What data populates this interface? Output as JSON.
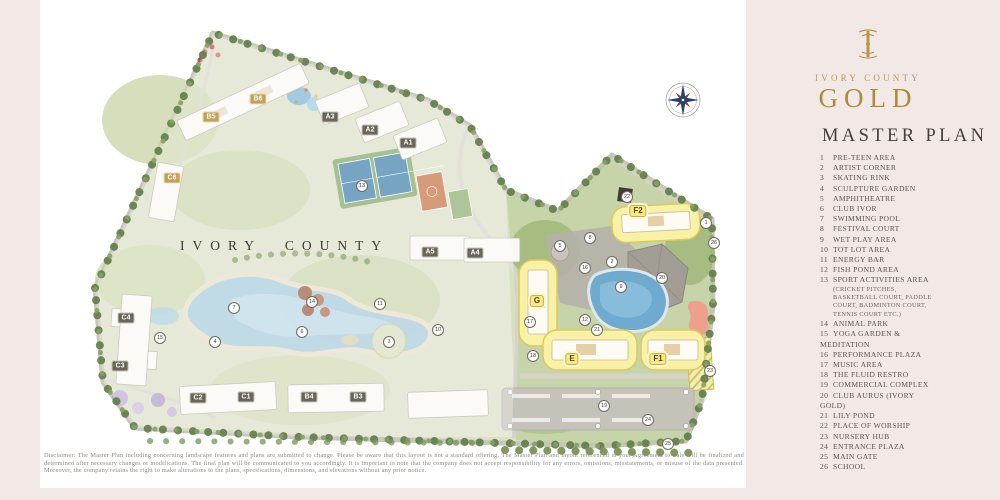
{
  "logo": {
    "brand": "IVORY COUNTY",
    "gold_word": "GOLD",
    "gold_color": "#ab8c3e"
  },
  "panel": {
    "title": "MASTER PLAN"
  },
  "legend": {
    "items": [
      {
        "n": "1",
        "label": "PRE-TEEN AREA"
      },
      {
        "n": "2",
        "label": "ARTIST CORNER"
      },
      {
        "n": "3",
        "label": "SKATING RINK"
      },
      {
        "n": "4",
        "label": "SCULPTURE GARDEN"
      },
      {
        "n": "5",
        "label": "AMPHITHEATRE"
      },
      {
        "n": "6",
        "label": "CLUB IVOR"
      },
      {
        "n": "7",
        "label": "SWIMMING POOL"
      },
      {
        "n": "8",
        "label": "FESTIVAL COURT"
      },
      {
        "n": "9",
        "label": "WET PLAY AREA"
      },
      {
        "n": "10",
        "label": "TOT LOT AREA"
      },
      {
        "n": "11",
        "label": "ENERGY BAR"
      },
      {
        "n": "12",
        "label": "FISH POND AREA"
      },
      {
        "n": "13",
        "label": "SPORT ACTIVITIES AREA",
        "sub": [
          "(CRICKET PITCHES,",
          "BASKETBALL COURT, PADDLE",
          "COURT, BADMINTON COURT,",
          "TENNIS  COURT ETC.)"
        ]
      },
      {
        "n": "14",
        "label": "ANIMAL PARK"
      },
      {
        "n": "15",
        "label": "YOGA GARDEN &",
        "cont": [
          "MEDITATION"
        ]
      },
      {
        "n": "16",
        "label": "PERFORMANCE PLAZA"
      },
      {
        "n": "17",
        "label": "MUSIC AREA"
      },
      {
        "n": "18",
        "label": "THE FLUID RESTRO"
      },
      {
        "n": "19",
        "label": "COMMERCIAL COMPLEX"
      },
      {
        "n": "20",
        "label": "CLUB AURUS (IVORY",
        "cont": [
          "GOLD)"
        ]
      },
      {
        "n": "21",
        "label": "LILY POND"
      },
      {
        "n": "22",
        "label": "PLACE OF WORSHIP"
      },
      {
        "n": "23",
        "label": "NURSERY HUB"
      },
      {
        "n": "24",
        "label": "ENTRANCE PLAZA"
      },
      {
        "n": "25",
        "label": "MAIN GATE"
      },
      {
        "n": "26",
        "label": "SCHOOL"
      }
    ]
  },
  "map": {
    "watermark": "IVORY COUNTY",
    "badges": [
      {
        "l": "B5",
        "x": 211,
        "y": 117,
        "s": "gold"
      },
      {
        "l": "B6",
        "x": 258,
        "y": 99,
        "s": "gold"
      },
      {
        "l": "A3",
        "x": 330,
        "y": 117,
        "s": "dark"
      },
      {
        "l": "A2",
        "x": 370,
        "y": 130,
        "s": "dark"
      },
      {
        "l": "A1",
        "x": 408,
        "y": 143,
        "s": "dark"
      },
      {
        "l": "A5",
        "x": 430,
        "y": 252,
        "s": "dark"
      },
      {
        "l": "A4",
        "x": 475,
        "y": 253,
        "s": "dark"
      },
      {
        "l": "C6",
        "x": 172,
        "y": 178,
        "s": "gold"
      },
      {
        "l": "C4",
        "x": 126,
        "y": 318,
        "s": "dark"
      },
      {
        "l": "C3",
        "x": 120,
        "y": 366,
        "s": "dark"
      },
      {
        "l": "C2",
        "x": 198,
        "y": 398,
        "s": "dark"
      },
      {
        "l": "C1",
        "x": 246,
        "y": 397,
        "s": "dark"
      },
      {
        "l": "B4",
        "x": 309,
        "y": 397,
        "s": "dark"
      },
      {
        "l": "B3",
        "x": 358,
        "y": 397,
        "s": "dark"
      },
      {
        "l": "F2",
        "x": 638,
        "y": 211,
        "s": "hl"
      },
      {
        "l": "G",
        "x": 537,
        "y": 301,
        "s": "hl"
      },
      {
        "l": "E",
        "x": 572,
        "y": 359,
        "s": "hl"
      },
      {
        "l": "F1",
        "x": 658,
        "y": 359,
        "s": "hl"
      }
    ],
    "markers": [
      {
        "n": "1",
        "x": 706,
        "y": 223
      },
      {
        "n": "2",
        "x": 612,
        "y": 262
      },
      {
        "n": "3",
        "x": 389,
        "y": 342
      },
      {
        "n": "4",
        "x": 215,
        "y": 342
      },
      {
        "n": "5",
        "x": 560,
        "y": 246
      },
      {
        "n": "6",
        "x": 302,
        "y": 332
      },
      {
        "n": "7",
        "x": 234,
        "y": 308
      },
      {
        "n": "8",
        "x": 590,
        "y": 238
      },
      {
        "n": "9",
        "x": 621,
        "y": 287
      },
      {
        "n": "10",
        "x": 438,
        "y": 330
      },
      {
        "n": "11",
        "x": 380,
        "y": 304
      },
      {
        "n": "12",
        "x": 585,
        "y": 320
      },
      {
        "n": "13",
        "x": 362,
        "y": 186
      },
      {
        "n": "14",
        "x": 312,
        "y": 302
      },
      {
        "n": "15",
        "x": 160,
        "y": 338
      },
      {
        "n": "16",
        "x": 585,
        "y": 268
      },
      {
        "n": "17",
        "x": 530,
        "y": 322
      },
      {
        "n": "18",
        "x": 533,
        "y": 356
      },
      {
        "n": "19",
        "x": 604,
        "y": 406
      },
      {
        "n": "20",
        "x": 662,
        "y": 278
      },
      {
        "n": "21",
        "x": 597,
        "y": 330
      },
      {
        "n": "22",
        "x": 627,
        "y": 197
      },
      {
        "n": "23",
        "x": 710,
        "y": 371
      },
      {
        "n": "24",
        "x": 648,
        "y": 420
      },
      {
        "n": "25",
        "x": 668,
        "y": 444
      },
      {
        "n": "26",
        "x": 714,
        "y": 243
      }
    ]
  },
  "disclaimer": {
    "text": "Disclaimer: The Master Plan including concerning landscape features and plans are submitted to change. Please be aware that this layout is not a standard offering. The Master Plan and layout referenced in your Agreement to Sale will be finalized and determined after necessary changes or modifications. The final plan will be communicated to you accordingly. It is important to note that the company does not accept responsibility for any errors, omissions, misstatements, or misuse of the data presented. Moreover, the company retains the right to make alterations to the plans, specifications, dimensions, and elevations without any prior notice."
  }
}
